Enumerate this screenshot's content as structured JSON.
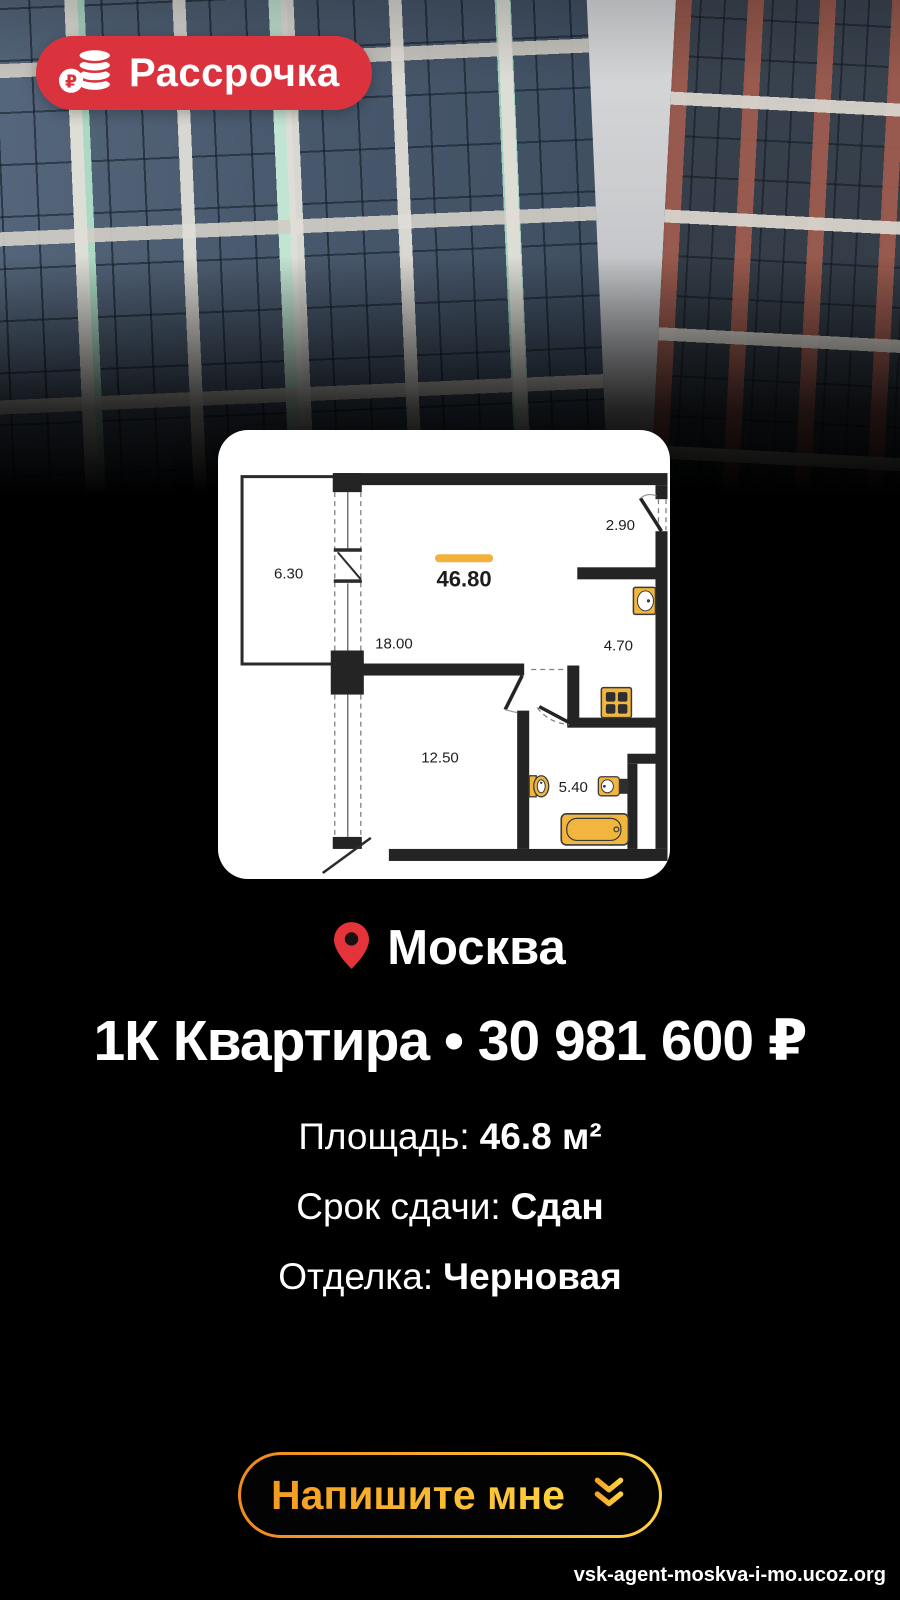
{
  "badge": {
    "label": "Рассрочка",
    "icon": "ruble-coins-icon",
    "bg_color": "#da333d"
  },
  "floorplan": {
    "total_area": "46.80",
    "areas": [
      "6.30",
      "2.90",
      "18.00",
      "4.70",
      "12.50",
      "5.40"
    ],
    "accent_color": "#f2b03c",
    "fixture_color": "#f2b63e"
  },
  "location": {
    "city": "Москва",
    "icon": "map-pin-icon",
    "pin_color": "#e5333a"
  },
  "title": {
    "text": "1К Квартира • 30 981 600 ₽"
  },
  "specs": [
    {
      "label": "Площадь:",
      "value": "46.8 м²"
    },
    {
      "label": "Срок сдачи:",
      "value": "Сдан"
    },
    {
      "label": "Отделка:",
      "value": "Черновая"
    }
  ],
  "cta": {
    "label": "Напишите мне",
    "icon": "double-chevron-down-icon",
    "gradient": [
      "#ef8a1d",
      "#ffd23f"
    ]
  },
  "footer": {
    "url": "vsk-agent-moskva-i-mo.ucoz.org"
  }
}
